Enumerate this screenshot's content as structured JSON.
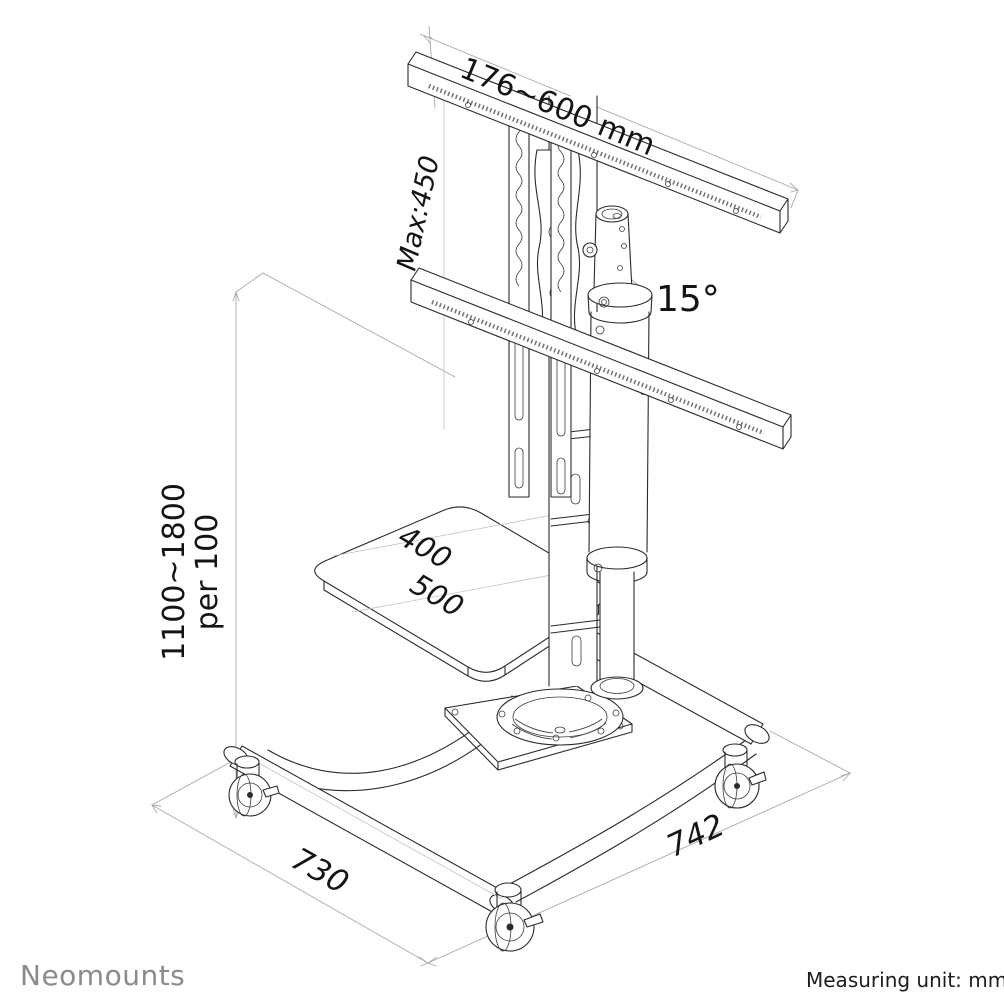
{
  "drawing": {
    "labels": {
      "mount_width": "176~600 mm",
      "mount_height": "Max:450",
      "tilt": "15°",
      "height_range": "1100~1800",
      "height_increment": "per 100",
      "shelf_depth": "400",
      "shelf_width": "500",
      "base_side_left": "730",
      "base_side_right": "742"
    }
  },
  "footer": {
    "brand": "Neomounts",
    "unit_note": "Measuring unit: mm"
  },
  "colors": {
    "line": "#2a2a2a",
    "dimension_line": "#a9a9a9",
    "text": "#141414",
    "brand": "#8b8b8b",
    "background": "#ffffff"
  }
}
